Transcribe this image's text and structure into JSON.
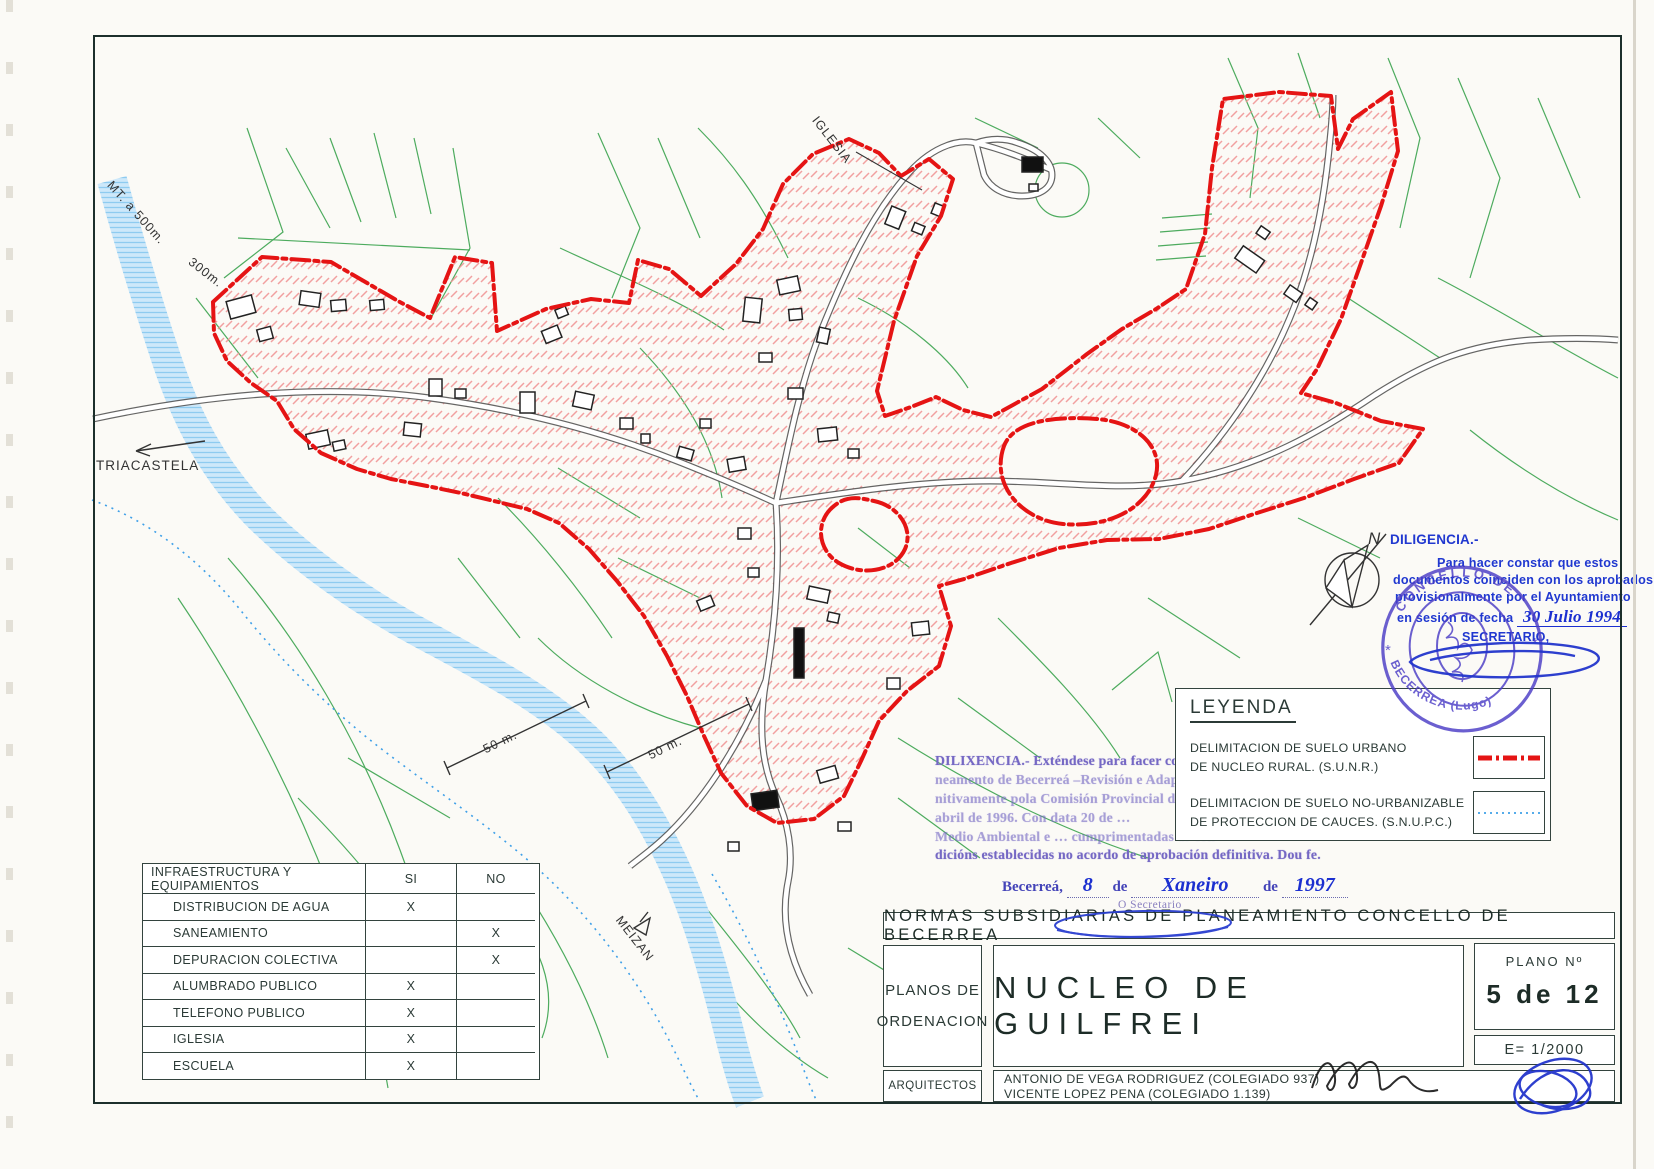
{
  "map_labels": {
    "iglesia": "IGLESIA",
    "mt_500": "MT. a 500m.",
    "m300": "300m.",
    "triacastela": "TRIACASTELA",
    "meizan": "MEIZAN",
    "scale_50_left": "50 m.",
    "scale_50_right": "50 m.",
    "north": "N"
  },
  "legend": {
    "title": "LEYENDA",
    "items": [
      {
        "line1": "DELIMITACION DE SUELO URBANO",
        "line2": "DE NUCLEO RURAL. (S.U.N.R.)",
        "symbol": "red-dash-dot-line"
      },
      {
        "line1": "DELIMITACION DE SUELO NO-URBANIZABLE",
        "line2": "DE PROTECCION DE CAUCES. (S.N.U.P.C.)",
        "symbol": "blue-dotted-line"
      }
    ]
  },
  "diligencia": {
    "title": "DILIGENCIA.-",
    "line1": "Para hacer constar que estos",
    "line2": "documentos coinciden con los aprobados",
    "line3": "provisionalmente por el Ayuntamiento",
    "line4": "en sesión de fecha",
    "date_handwritten": "30 Julio 1994",
    "signoff": "SECRETARIO,"
  },
  "stamp": {
    "arc_top": "CONCELLO DE",
    "arc_bottom": "BECERREA (Lugo)",
    "stars": "*"
  },
  "dilixencia": {
    "lines": [
      "DILIXENCIA.- Exténdese para facer constar que as Normas Subsidiarias de Pla-",
      "neamento de Becerreá –Revisión e Adaptación á LASGA– foron aprobadas defi-",
      "nitivamente pola Comisión Provincial de Urbanismo … de 25 de",
      "abril de 1996. Con data 20 de …",
      "Medio Ambiental e … cumprimentadas as con-",
      "dicións establecidas no acordo de aprobación definitiva. Dou fe."
    ]
  },
  "date_line": {
    "place": "Becerreá,",
    "day": "8",
    "de1": "de",
    "month": "Xaneiro",
    "de2": "de",
    "year": "1997",
    "secretario": "O Secretario"
  },
  "infra_table": {
    "header": {
      "col1": "INFRAESTRUCTURA Y EQUIPAMIENTOS",
      "col2": "SI",
      "col3": "NO"
    },
    "rows": [
      {
        "label": "DISTRIBUCION DE AGUA",
        "si": "X",
        "no": ""
      },
      {
        "label": "SANEAMIENTO",
        "si": "",
        "no": "X"
      },
      {
        "label": "DEPURACION COLECTIVA",
        "si": "",
        "no": "X"
      },
      {
        "label": "ALUMBRADO PUBLICO",
        "si": "X",
        "no": ""
      },
      {
        "label": "TELEFONO PUBLICO",
        "si": "X",
        "no": ""
      },
      {
        "label": "IGLESIA",
        "si": "X",
        "no": ""
      },
      {
        "label": "ESCUELA",
        "si": "X",
        "no": ""
      }
    ]
  },
  "title_block": {
    "header": "NORMAS SUBSIDIARIAS DE PLANEAMIENTO CONCELLO DE BECERREA",
    "series_line1": "PLANOS DE",
    "series_line2": "ORDENACION",
    "sheet_title": "NUCLEO DE GUILFREI",
    "plano_label": "PLANO Nº",
    "plano_value": "5 de 12",
    "scale": "E= 1/2000",
    "architects_label": "ARQUITECTOS",
    "architect_1": "ANTONIO DE VEGA RODRIGUEZ (COLEGIADO 937)",
    "architect_2": "VICENTE LOPEZ PENA (COLEGIADO 1.139)"
  },
  "colors": {
    "boundary_red": "#e51414",
    "hatch_pink": "#f09090",
    "river_blue": "#cde8fa",
    "cauces_blue": "#3fa0e8",
    "parcel_green": "#2f9e44",
    "road_gray": "#555555",
    "ink_blue": "#2038d0",
    "stamp_violet": "#4b3dc6",
    "faded_purple": "#7568c4",
    "frame_dark": "#1c2f2b"
  }
}
